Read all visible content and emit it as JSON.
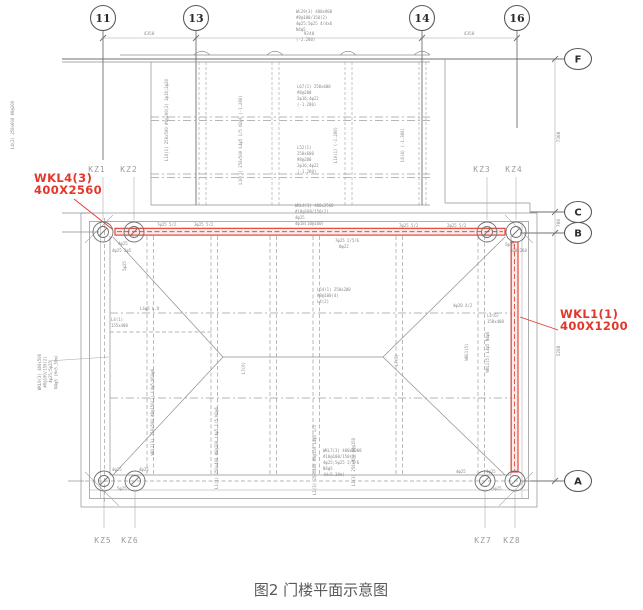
{
  "caption": "图2 门楼平面示意图",
  "colors": {
    "red": "#e2372b",
    "line": "#8e8e8e",
    "label": "#9b9b9b",
    "caption": "#595959"
  },
  "axes": {
    "cols": [
      "11",
      "13",
      "14",
      "16"
    ],
    "rows": [
      "F",
      "C",
      "B",
      "A"
    ]
  },
  "dims": {
    "top": [
      "4350",
      "9240",
      "4350"
    ],
    "right": [
      "7300",
      "700",
      "5280"
    ]
  },
  "kz": [
    "KZ1",
    "KZ2",
    "KZ3",
    "KZ4",
    "KZ5",
    "KZ6",
    "KZ7",
    "KZ8"
  ],
  "red_labels": {
    "wkl4": [
      "WKL4(3)",
      "400X2560"
    ],
    "wkl1": [
      "WKL1(1)",
      "400X1200"
    ]
  },
  "micro": {
    "top_block": [
      "WL29(3) 400x900",
      "#8@100/150(2)",
      "4φ25;5φ25 4/4x6",
      "N4φ5",
      "(-2.280)"
    ],
    "l67_block": [
      "L67(1) 250x600",
      "#8@200",
      "2φ16;4φ22",
      "(-1.280)"
    ],
    "l52_block": [
      "L52(1)",
      "250x600",
      "#8@200",
      "2φ16;4φ22",
      "(-1.280)"
    ],
    "wkl4_block": [
      "WKL4(3) 400x2560",
      "#10@100/150(2)",
      "4φ25",
      "4φ18(10@100)"
    ],
    "wkl7_block": [
      "WKL7(3) 400x2060",
      "#10@100/150(2)",
      "4φ25;5φ25 2/5/6",
      "N4φ5",
      "(H=5.30m)"
    ],
    "l54_block": [
      "L54(1) 250x200",
      "#8@100(4)",
      "L4(2)"
    ],
    "bars_block": [
      "7φ25 2/5/6",
      "8φ22"
    ],
    "l4_block": [
      "L4(1)",
      "155x400"
    ],
    "l46_block": [
      "L4(6)",
      "150x400"
    ],
    "l4_top": "L4φ5 L.O",
    "rot_left_out": [
      "WKL9(3) 400x500",
      "#8@100/150(2)",
      "4φ25;5φ25",
      "N4φ5 (H=5.30m)"
    ],
    "rot_margin": "L4(2) 250x600 #8@200",
    "rot_upper": [
      "L10(1) 250x500 #8@200(2) 2φ16;2φ20",
      "L10(1) 250x500 L4φ5 1/5 N2φ6 (-1.280)",
      "L10(1) (-1.280)",
      "L6(4) (-1.380)"
    ],
    "rot_plan": [
      "WKL2(3) 250x500 #8@150(2) L4φ5;N10φ6",
      "L1(1) 250x400 #8@200 L4φ5 1/5 N2φ6",
      "L1(3) 250x400 #8@150 L4φ5 1/5",
      "L1(3) 250x400 #8@150",
      "L7(6)",
      "L7(6)",
      "WKL1(5)",
      "WKL1(5) L4φ5 N4φ6",
      "5φ25"
    ],
    "tiny": [
      "7φ25 5/2",
      "3φ25 5/2",
      "7φ25 5/2",
      "2φ25 5/2",
      "4φ25",
      "4φ25 2φ5",
      "5φ25",
      "400x260",
      "4φ20 4/2",
      "4φ25",
      "4φ25",
      "5φ25",
      "4φ25",
      "4φ25",
      "5φ25"
    ]
  }
}
